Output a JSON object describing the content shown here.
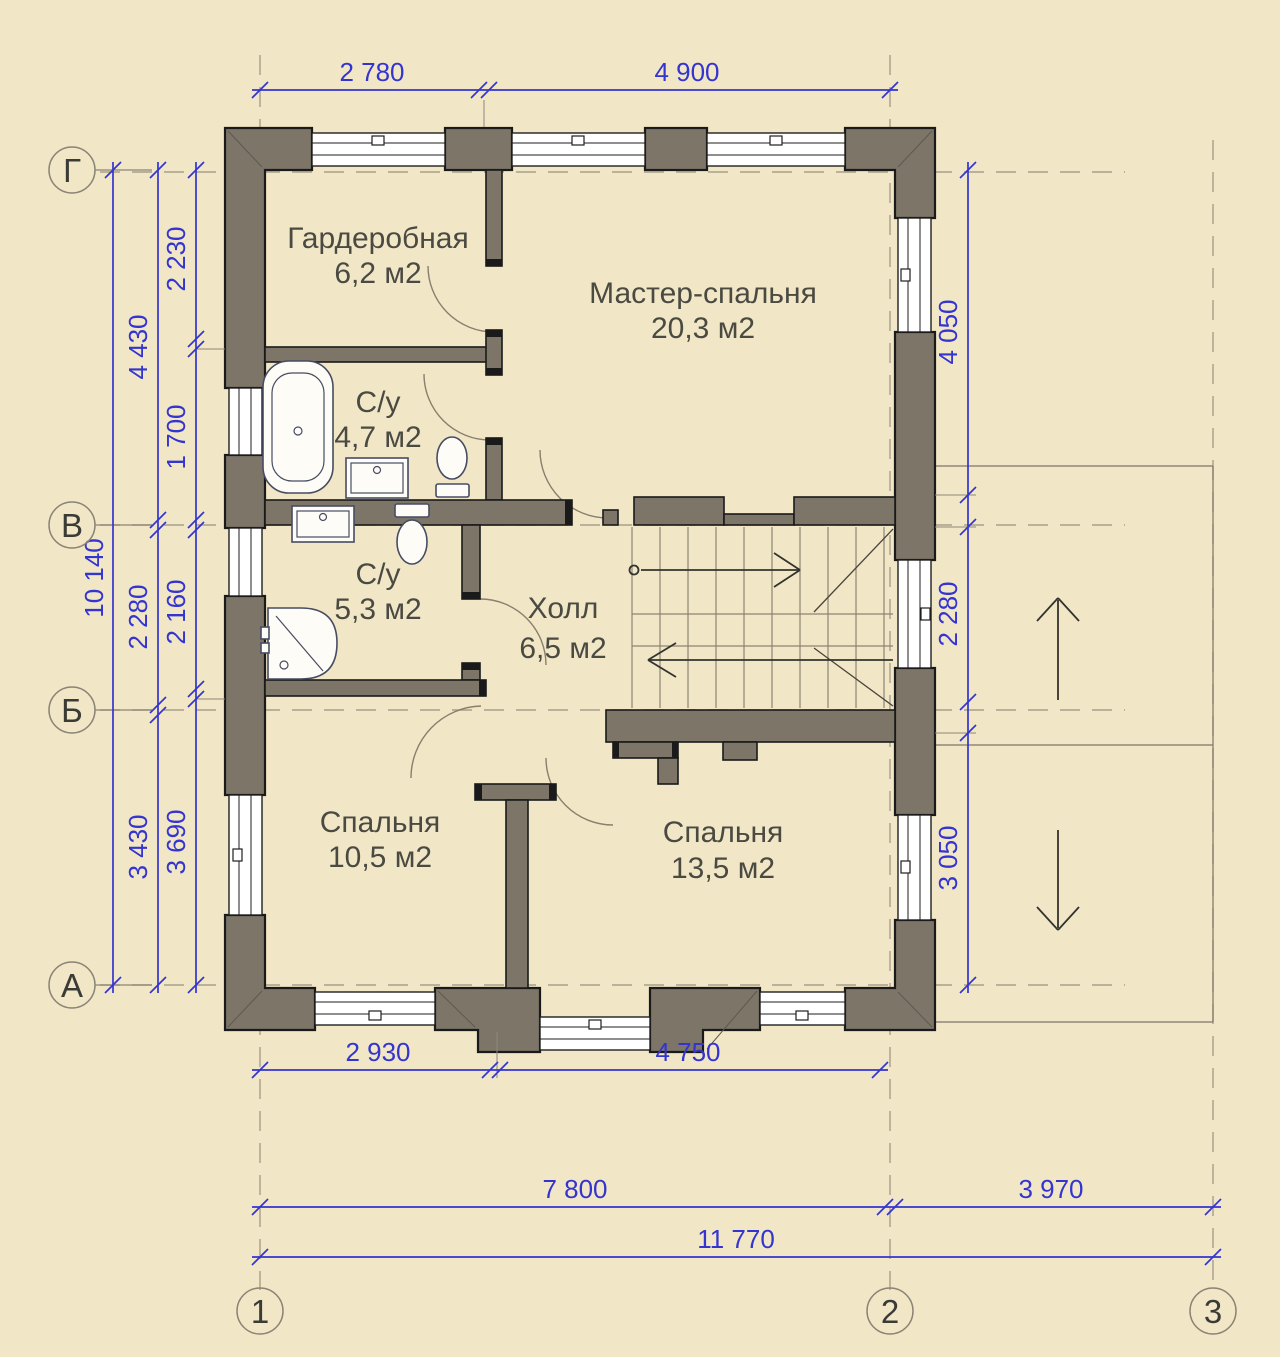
{
  "plan": {
    "rooms": [
      {
        "name": "Гардеробная",
        "area": "6,2 м2"
      },
      {
        "name": "Мастер-спальня",
        "area": "20,3 м2"
      },
      {
        "name": "С/у",
        "area": "4,7 м2"
      },
      {
        "name": "С/у",
        "area": "5,3 м2"
      },
      {
        "name": "Холл",
        "area": "6,5 м2"
      },
      {
        "name": "Спальня",
        "area": "10,5 м2"
      },
      {
        "name": "Спальня",
        "area": "13,5 м2"
      }
    ],
    "axes": {
      "rows": [
        "Г",
        "В",
        "Б",
        "А"
      ],
      "cols": [
        "1",
        "2",
        "3"
      ]
    },
    "dims": {
      "top": [
        "2 780",
        "4 900"
      ],
      "left_overall": "10 140",
      "left_outer": [
        "4 430",
        "2 280",
        "3 430"
      ],
      "left_inner": [
        "2 230",
        "1 700",
        "2 160",
        "3 690"
      ],
      "right": [
        "4 050",
        "2 280",
        "3 050"
      ],
      "bottom_inner": [
        "2 930",
        "4 750"
      ],
      "bottom_axes": [
        "7 800",
        "3 970"
      ],
      "bottom_overall": "11 770"
    },
    "colors": {
      "background": "#f1e7c7",
      "wall": "#7c7568",
      "outline": "#1a1a1a",
      "dimension": "#3434d0",
      "axis_dash": "#a89f8c",
      "label": "#4b4a42",
      "window": "#ffffff"
    }
  }
}
